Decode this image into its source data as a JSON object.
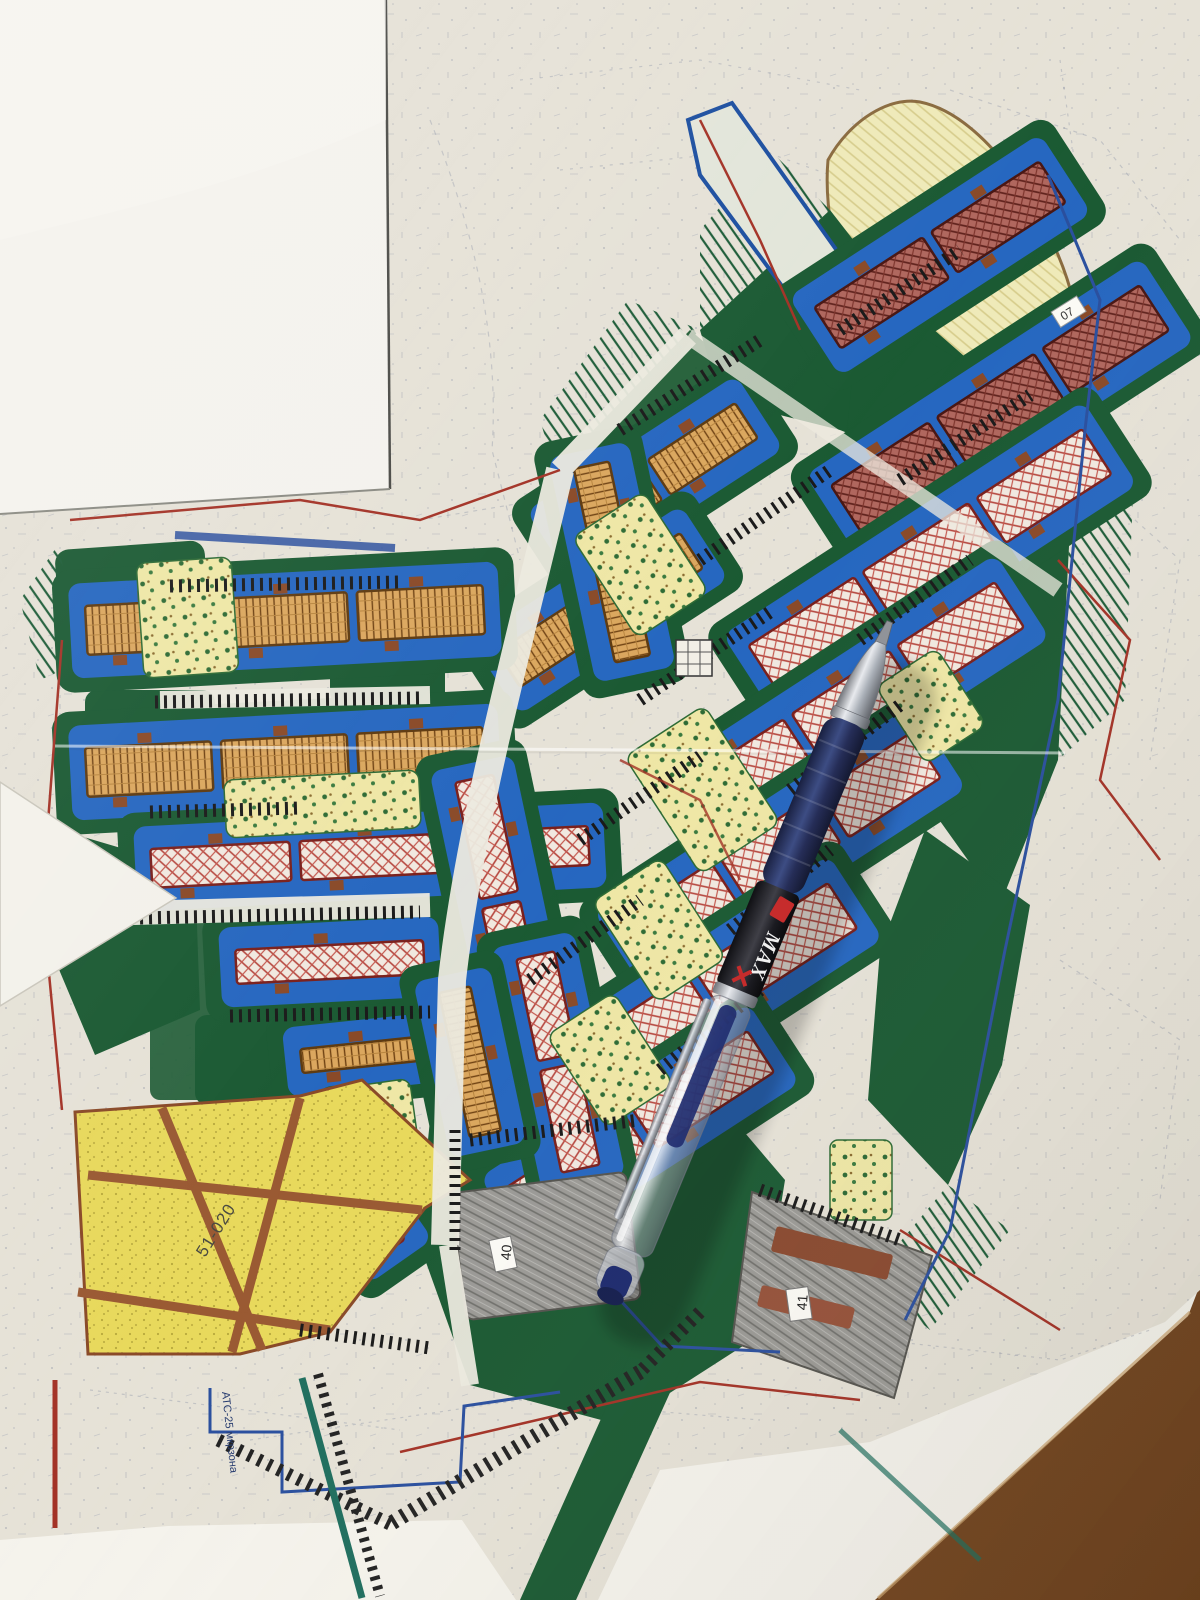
{
  "photo": {
    "labels": {
      "district_code": "51-020",
      "parcel_40": "40",
      "parcel_41": "41",
      "atc_note": "АТС-25 мкрзона",
      "parcel_07": "07"
    },
    "pen": {
      "brand_text": "MAX"
    },
    "colors": {
      "courtyard_blue": "#2667c0",
      "park_green": "#1b5a33",
      "residential_hatch_red": "#b5443c",
      "lowrise_tan": "#d9a55d",
      "playground_yellow": "#efe7a6",
      "estate_yellow": "#e8d95c",
      "parking_gray": "#9b9a96",
      "road_paper": "#e9e5da",
      "utility_red": "#a33226",
      "utility_blue": "#2a4f9e",
      "table_wood": "#7c4a22"
    }
  }
}
